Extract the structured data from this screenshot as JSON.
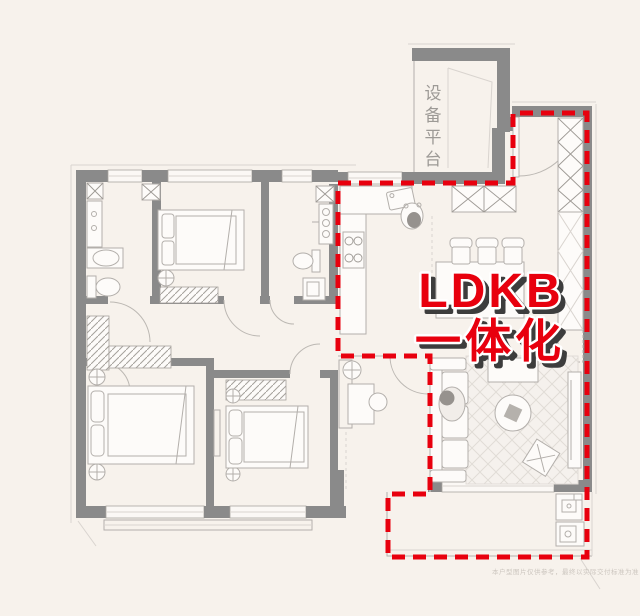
{
  "canvas": {
    "width": 640,
    "height": 616,
    "background": "#f7f2ec"
  },
  "labels": {
    "equipment_platform": "设备平台"
  },
  "annotation": {
    "line1": "LDKB",
    "line2": "一体化",
    "text_color": "#e8000e",
    "shadow_color": "#3d3d3d",
    "halo_color": "#ffffff"
  },
  "overlay": {
    "dashed_outline_color": "#e8000e"
  },
  "watermark": "本户型图片仅供参考，最终以实际交付标准为准",
  "colors": {
    "wall": "#8a8a8a",
    "thin_line": "#b3afab",
    "background": "#f7f2ec"
  }
}
